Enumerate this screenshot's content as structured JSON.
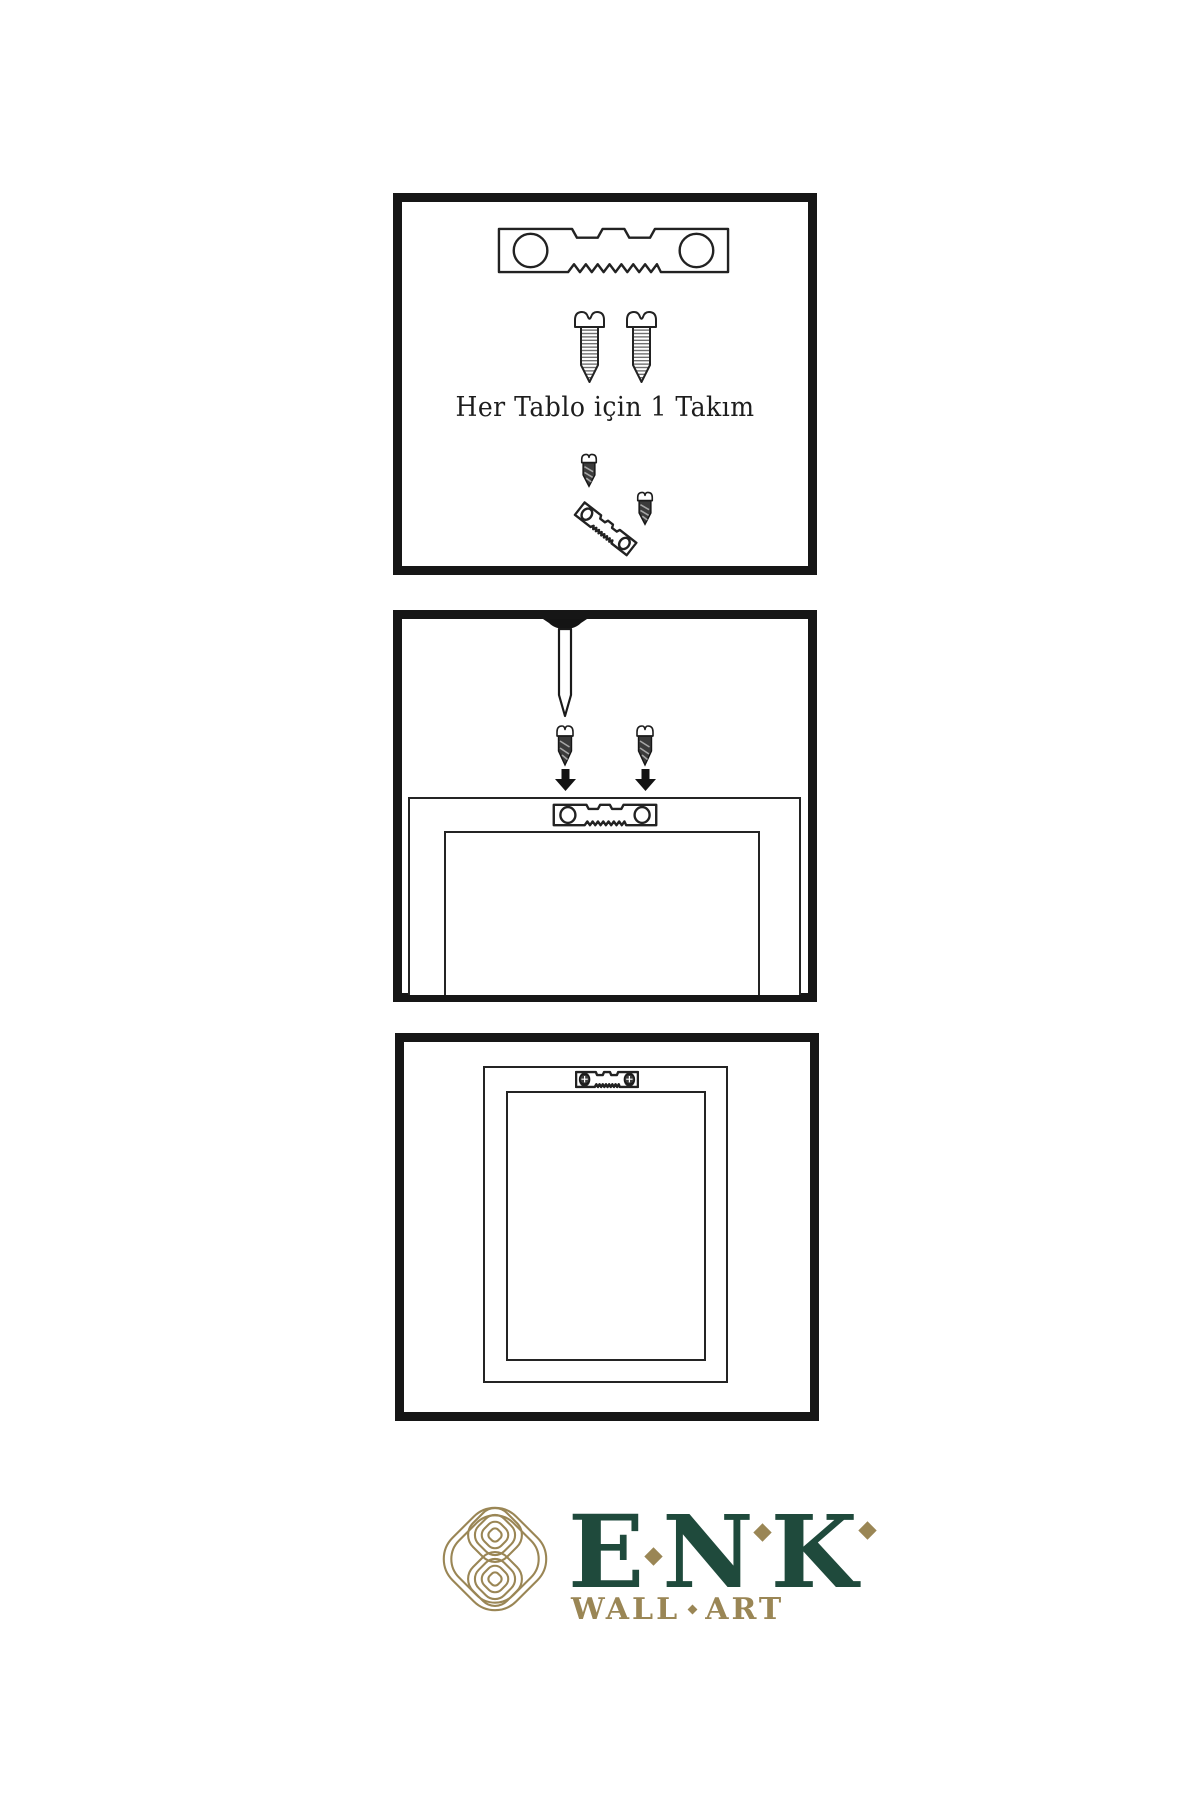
{
  "page": {
    "background": "#ffffff",
    "language": "tr"
  },
  "colors": {
    "panel_border": "#161616",
    "line_ink": "#222222",
    "screw_dark_fill": "#3b3b3b",
    "logo_green": "#1f4a3c",
    "logo_gold": "#9a8655"
  },
  "steps": [
    {
      "name": "kit-contents",
      "caption": "Her Tablo için 1 Takım",
      "icons": [
        "sawtooth-hanger-icon",
        "screw-icon",
        "screw-icon",
        "angled-hanger-with-screws-icon"
      ]
    },
    {
      "name": "attach-hanger-and-wall-nail",
      "icons": [
        "wall-nail-icon",
        "dark-screw-icon",
        "dark-screw-icon",
        "down-arrow-icon",
        "down-arrow-icon",
        "frame-back-with-sawtooth-hanger-icon"
      ]
    },
    {
      "name": "mounted-frame",
      "icons": [
        "frame-back-with-screwed-hanger-icon"
      ]
    }
  ],
  "logo": {
    "letters": [
      "E",
      "N",
      "K"
    ],
    "tagline_words": [
      "WALL",
      "ART"
    ]
  }
}
